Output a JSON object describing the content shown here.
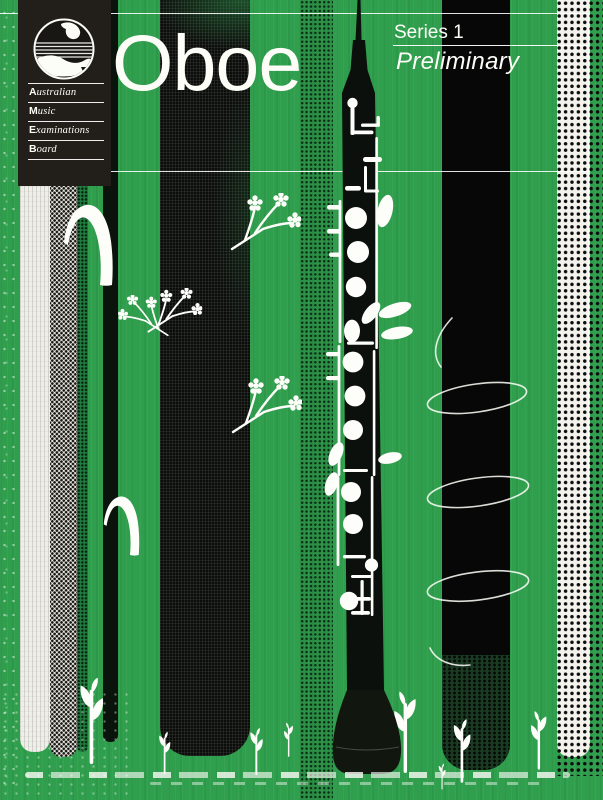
{
  "cover": {
    "title": "Oboe",
    "series_label": "Series 1",
    "grade_label": "Preliminary"
  },
  "logo_panel": {
    "org_name_lines": [
      {
        "initial": "A",
        "rest": "ustralian"
      },
      {
        "initial": "M",
        "rest": "usic"
      },
      {
        "initial": "E",
        "rest": "xaminations"
      },
      {
        "initial": "B",
        "rest": "oard"
      }
    ]
  },
  "colors": {
    "green": "#2f9e4d",
    "ink": "#0b0e0b",
    "panel": "#221f1b",
    "paper": "#f2f1ea",
    "text": "#fdfdf8"
  },
  "illustrations": {
    "logo": "ameb-crest-logo",
    "instrument": "oboe-silhouette",
    "sprig": "berry-sprig-icon",
    "seedling": "seedling-icon",
    "coil": "wire-coil-line",
    "blade": "curved-blade-shape"
  }
}
